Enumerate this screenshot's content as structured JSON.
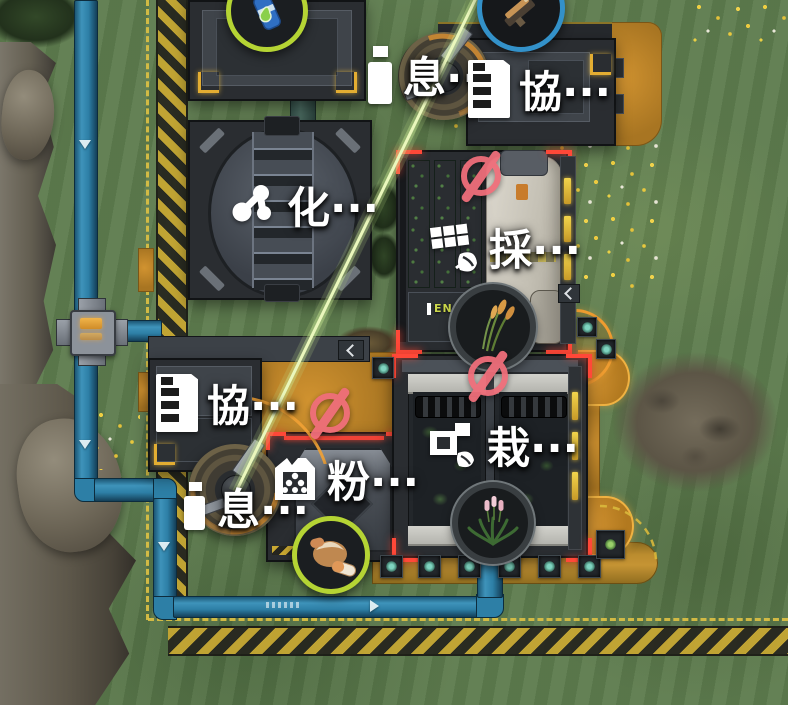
{
  "labels": {
    "rest_top": "息···",
    "coop_top": "協···",
    "chem": "化···",
    "harvest": "採···",
    "coop_left": "協···",
    "rest_bottom": "息···",
    "mill": "粉···",
    "plant": "栽···"
  },
  "building_tags": {
    "energy": "EN"
  },
  "items": {
    "canister": "blue-canister-with-green-droplet",
    "tool": "orange-device",
    "wheat": "wheat-stalks",
    "plant": "flowering-plant",
    "food": "bread-and-capsules"
  },
  "colors": {
    "ring_green": "#b5d434",
    "ring_blue": "#3391c9",
    "prohibited_pink": "#ef6e7a",
    "beam_green": "#eaf7bc",
    "pipe_blue": "#2d7fa6",
    "pavement_orange": "#c8862e",
    "hazard_yellow": "#c9a832",
    "selection_red": "#ff4838",
    "label_white": "#ffffff"
  }
}
